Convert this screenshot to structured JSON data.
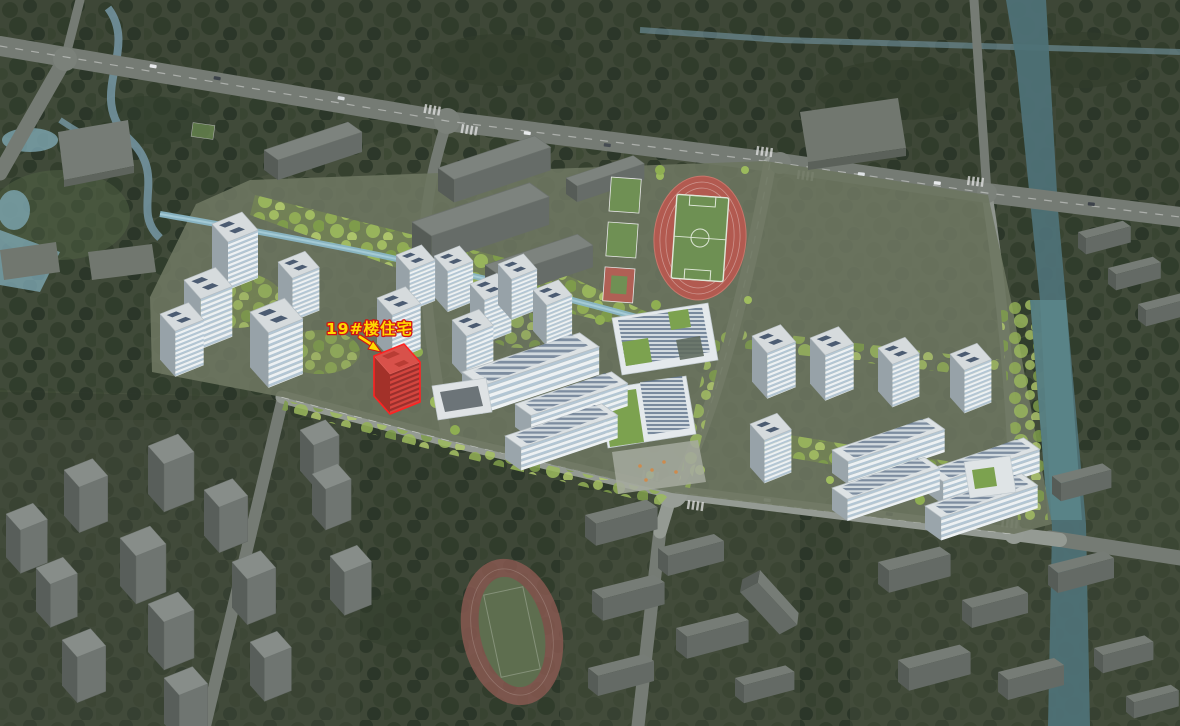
{
  "annotation": {
    "label": "19#楼住宅"
  },
  "colors": {
    "highlight_fill": "#d2453e",
    "highlight_roof": "#d8514a",
    "highlight_outline": "#ff2222",
    "label_text": "#ffd900",
    "label_outline": "#cf1414",
    "site_tree_green": "#9ab95c",
    "context_green": "#3a452f",
    "water": "#7fa8b6",
    "road_gray": "#8b918b"
  }
}
